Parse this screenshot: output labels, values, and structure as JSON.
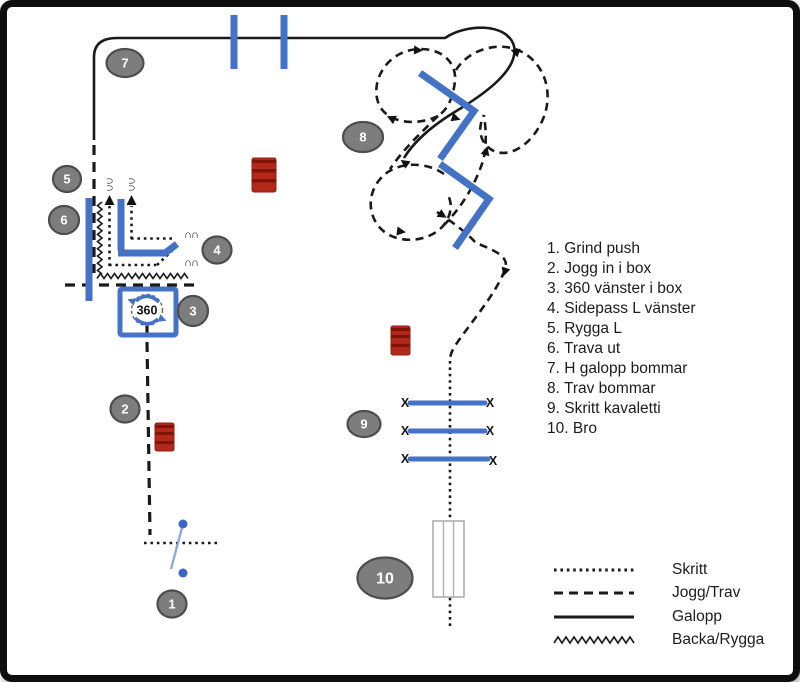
{
  "colors": {
    "accent_blue": "#4472C4",
    "gate_blue": "#3B66C8",
    "gate_bar_blue": "#8FA8DC",
    "barrel_red": "#B3281A",
    "barrel_band": "#7E1507",
    "circle_gray": "#7D7D7D",
    "circle_border": "#4D4D4D",
    "bridge_gray": "#ADADAD",
    "line_black": "#1A1A1A"
  },
  "badges": [
    "1",
    "2",
    "3",
    "4",
    "5",
    "6",
    "7",
    "8",
    "9",
    "10"
  ],
  "markers": {
    "turn": "360",
    "kavaletti_end": "X",
    "horseshoe": "∩∩"
  },
  "obstacles": {
    "items": [
      "1. Grind push",
      "2. Jogg in i box",
      "3. 360 vänster i box",
      "4. Sidepass L vänster",
      "5. Rygga L",
      "6. Trava ut",
      "7. H galopp bommar",
      "8. Trav bommar",
      "9. Skritt kavaletti",
      "10. Bro"
    ]
  },
  "legend": {
    "items": [
      {
        "label": "Skritt",
        "style": "dotted"
      },
      {
        "label": "Jogg/Trav",
        "style": "dashed"
      },
      {
        "label": "Galopp",
        "style": "solid"
      },
      {
        "label": "Backa/Rygga",
        "style": "zigzag"
      }
    ]
  }
}
